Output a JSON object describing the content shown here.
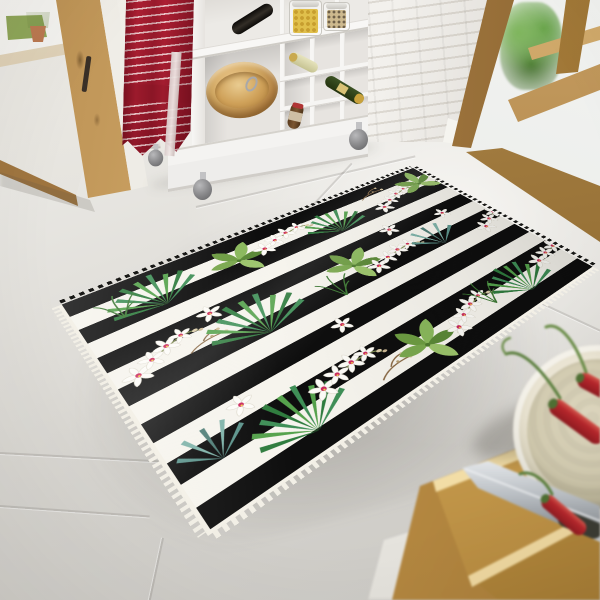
{
  "meta": {
    "title": "Tropical orchid striped rug in a kitchen — product photo",
    "domain": "natural-image",
    "description": "Photograph of a black and white horizontally striped area rug printed with white orchid flowers, green palm fan leaves, broad tropical leaves and brown twigs, lying at an angle on a light grey tiled kitchen floor between wooden glass doors, a white cubby storage cart and a foreground wooden table."
  },
  "scene": {
    "objects": {
      "left_door": {
        "label": "Wooden-framed glass patio door showing an outdoor path, grass and a terracotta plant pot"
      },
      "towel": {
        "label": "Red kitchen towel with thin white stripes hanging from the white cart"
      },
      "cart": {
        "label": "White cube-shelf kitchen cart on caster wheels",
        "contents": [
          "glass jar with yellow pasta",
          "glass jar with mixed grains",
          "dark wine bottle lying on top",
          "pale wine bottle in cubby",
          "green wine bottle in cubby",
          "brown bottle with red cap",
          "wooden salad bowl",
          "metal whisk"
        ]
      },
      "brick_wall": {
        "label": "White painted brick wall section"
      },
      "right_door": {
        "label": "Wooden glass door with a potted fern visible behind the glass"
      },
      "floor": {
        "label": "Light grey large-format tiled floor"
      },
      "rug": {
        "label": "Black and white striped tropical rug with white orchids and green palm leaves, white tassel fringe on near edges",
        "stripe_colors": {
          "black": "#0e0e0e",
          "white": "#f6f4ed"
        },
        "motifs": [
          "white orchid flowers with crimson-pink and yellow centers",
          "green fan palm leaves",
          "teal fan palm leaves",
          "broad tropical leaf clusters",
          "grass tufts",
          "brown twigs with buds"
        ],
        "fringe": "white tassels on left and bottom edges, dark serrated far edges"
      },
      "table": {
        "label": "Warm oak table with two stacked wooden cutting boards"
      },
      "knife": {
        "label": "Chef's knife with steel blade and dark handle"
      },
      "bowl": {
        "label": "Cream ceramic bowl holding red chili peppers"
      },
      "chilies": {
        "label": "Red chili peppers with curled green stems",
        "count_visible": 3
      }
    },
    "palette": {
      "floor_grey": "#d8d6d1",
      "wall_white": "#f1efe9",
      "wood_oak": "#b1823f",
      "towel_red": "#a21c2f",
      "rug_black": "#0e0e0e",
      "rug_white": "#f6f4ed",
      "leaf_green": "#55a24c",
      "leaf_dark": "#2f7c3e",
      "leaf_teal": "#5d948c",
      "orchid_center_pink": "#cb2a5e",
      "orchid_yellow": "#f1d04a",
      "chili_red": "#b5262b",
      "board_wood": "#d9b469"
    }
  }
}
